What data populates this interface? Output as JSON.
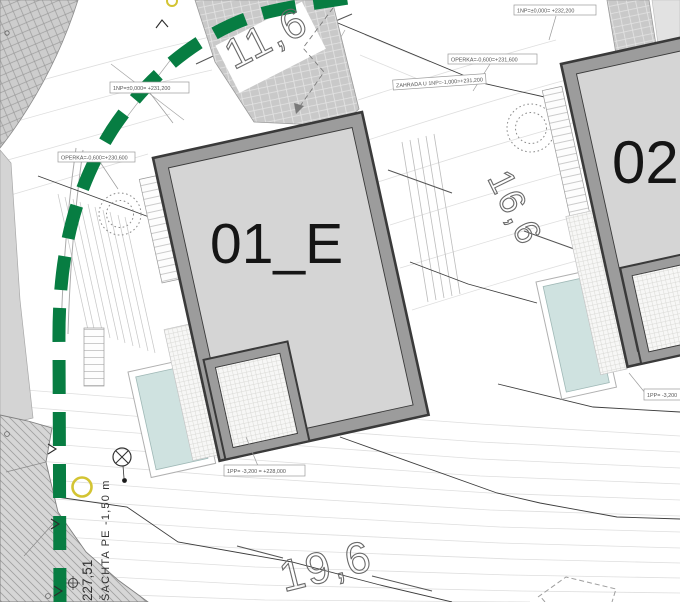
{
  "plan": {
    "buildings": [
      {
        "name": "01_E",
        "levels": {
          "np1": "1NP=±0,000= +231,200",
          "operka": "OPERKA=-0,600=+230,600",
          "pp1": "1PP= -3,200 = +228,000"
        }
      },
      {
        "name": "02",
        "levels": {
          "np1": "1NP=±0,000= +232,200",
          "operka": "OPERKA=-0,600=+231,600",
          "zahrada": "ZAHRADA U 1NP=-1,000=+231,200",
          "pp1": "1PP= -3,200"
        }
      }
    ],
    "dimensions": {
      "top": "11,6",
      "middle": "16,6",
      "bottom": "19,6"
    },
    "survey": {
      "elevation": "227,51",
      "shaft_note": "ŠACHTA PE -1,50 m"
    },
    "colors": {
      "boundary_green": "#077d42",
      "pool_water": "#cfe2e0",
      "building_fill": "#d5d5d5",
      "wall_gray": "#9c9c9c",
      "paving_gray": "#c9c9c9",
      "yellow_marker": "#d3c433"
    }
  }
}
